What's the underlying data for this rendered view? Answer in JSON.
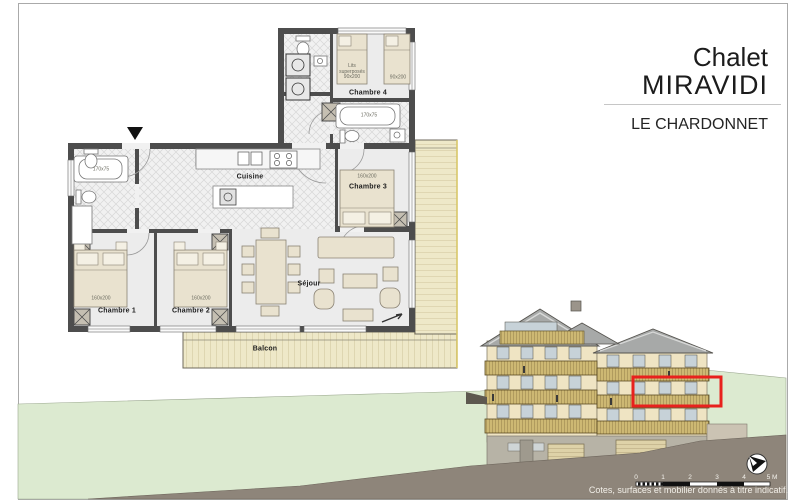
{
  "title_block": {
    "line1": "Chalet",
    "line2": "MIRAVIDI",
    "project": "LE CHARDONNET"
  },
  "floor_plan": {
    "rooms": {
      "chambre1": "Chambre 1",
      "chambre2": "Chambre 2",
      "chambre3": "Chambre 3",
      "chambre4": "Chambre 4",
      "cuisine": "Cuisine",
      "sejour": "Séjour",
      "balcon": "Balcon"
    },
    "dimensions": {
      "bed1": "160x200",
      "bed2": "160x200",
      "bed3": "160x200",
      "bed4": "90x200",
      "bunk": "Lits superposés 90x200",
      "tub_left": "170x75",
      "tub_right": "170x75"
    }
  },
  "footer": {
    "scale_ticks": [
      "0",
      "1",
      "2",
      "3",
      "4",
      "5 M"
    ],
    "disclaimer": "Cotes, surfaces et mobilier donnés à titre indicatif."
  },
  "elevation": {
    "highlight_color": "#e8211d"
  },
  "colors": {
    "grass": "#dcead0",
    "ground": "#8e857a",
    "facade": "#efe4c3",
    "roof": "#a7a9a8",
    "balcony_wood": "#eee8c8",
    "wall": "#4d4d4d"
  }
}
